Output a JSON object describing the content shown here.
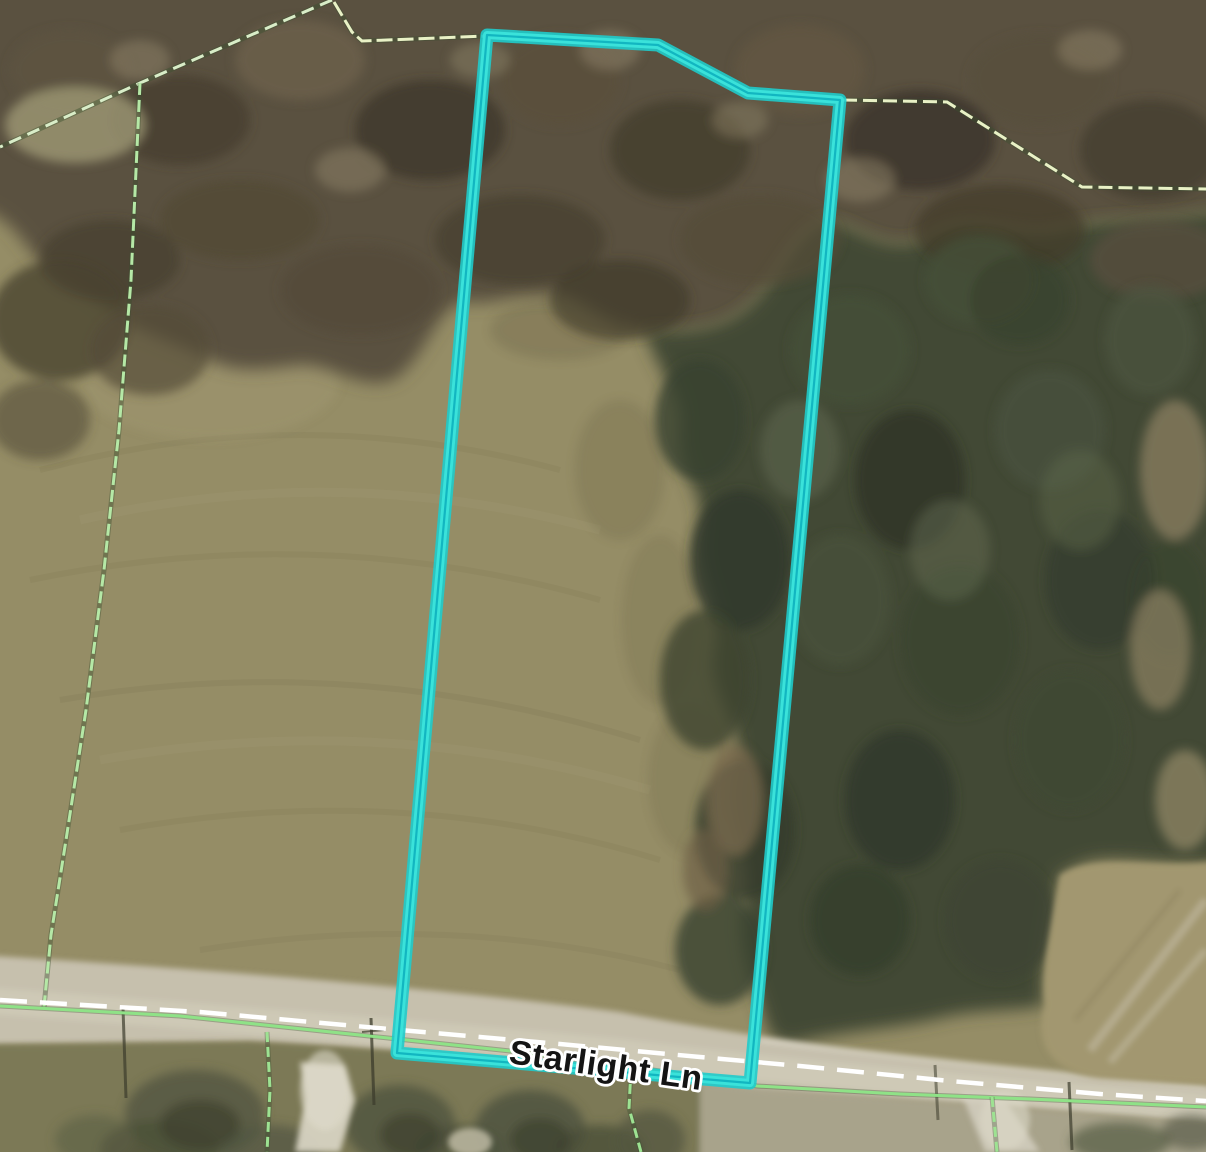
{
  "map": {
    "road_label": "Starlight Ln",
    "colors": {
      "parcel_highlight": "#1FCBCB",
      "parcel_highlight_bright": "#3AE2DA",
      "parcel_highlight_core": "#0CAEBC",
      "boundary_green_road": "#8FE287",
      "boundary_green_left": "#B5E8A6",
      "boundary_green_dashed": "#9DE292",
      "survey_line_pale": "#E9F1C6",
      "survey_line_pale_nw": "#D9EDC8",
      "road_centerline_white": "#FFFFFF",
      "label_fill": "#141414",
      "label_halo": "#FFFFFF"
    }
  }
}
